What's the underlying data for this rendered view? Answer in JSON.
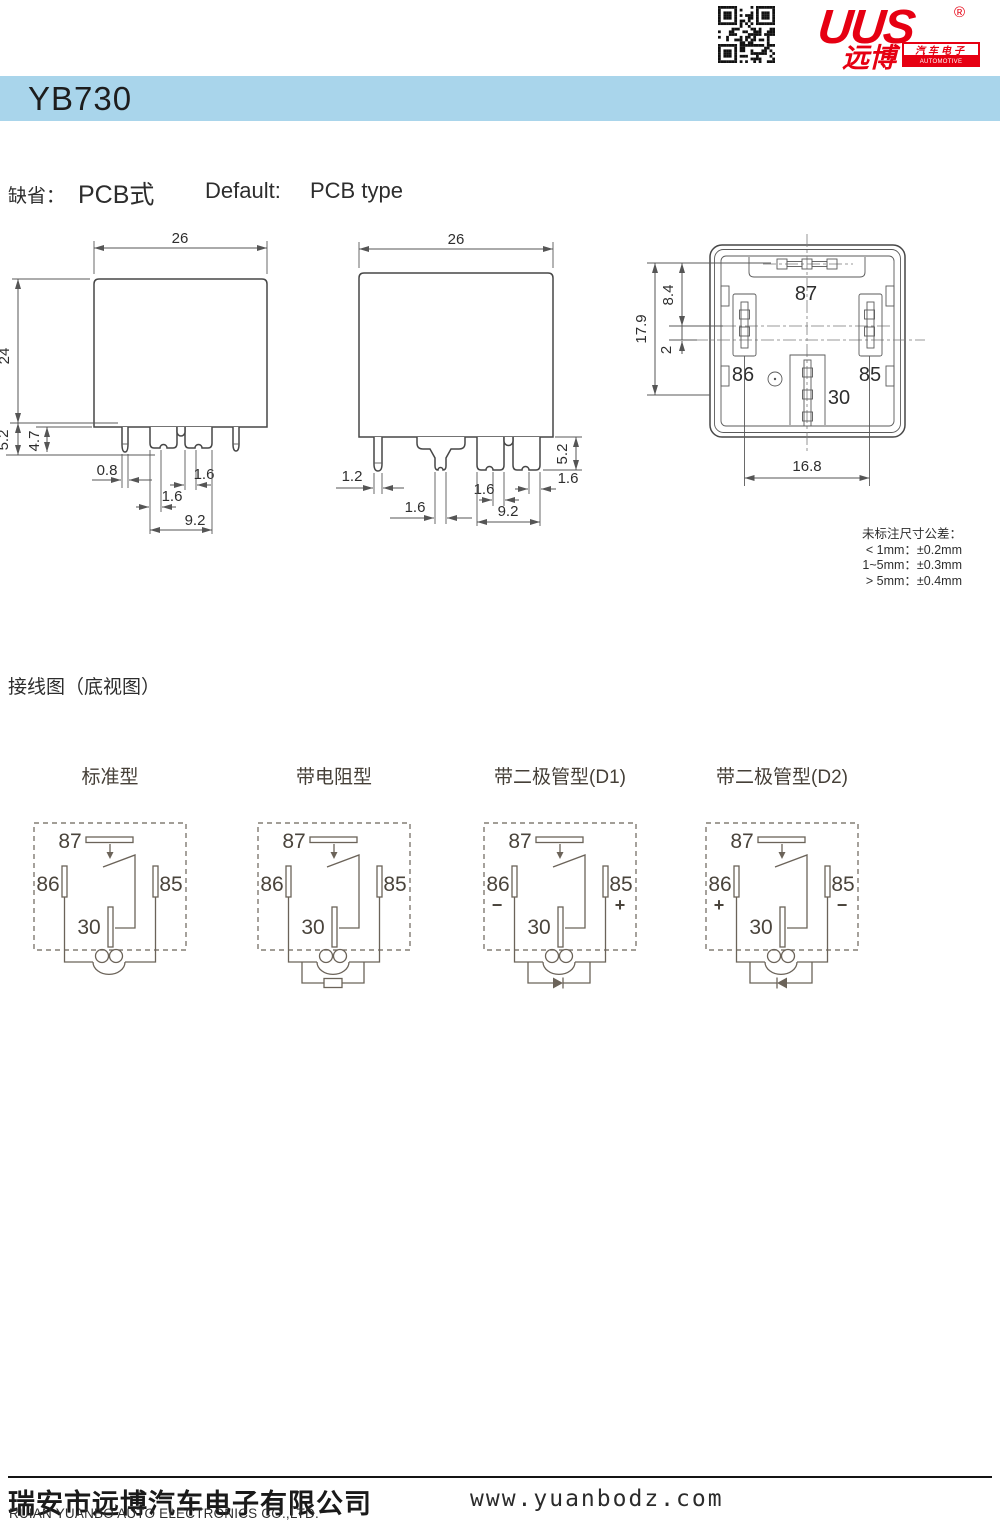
{
  "colors": {
    "accent_red": "#e60012",
    "header_blue": "#a9d5eb"
  },
  "brand": {
    "logo_text": "UUS",
    "registered": "®",
    "logo_cn": "远博",
    "logo_cn_tag": "汽车电子",
    "logo_en_tag": "AUTOMOTIVE ELECTRONICS"
  },
  "header": {
    "title": "YB730"
  },
  "default_line": {
    "label_cn": "缺省：",
    "value_cn": "PCB式",
    "label_en": "Default:",
    "value_en": "PCB type"
  },
  "drawings": {
    "side_a": {
      "w": "26",
      "h": "24",
      "pin": "5.2",
      "pin2": "4.7",
      "round": "0.8",
      "blade1": "1.6",
      "blade2": "1.6",
      "pitch": "9.2"
    },
    "side_b": {
      "w": "26",
      "round": "1.2",
      "center_blade": "1.6",
      "blade1": "1.6",
      "blade2": "1.6",
      "pitch": "9.2",
      "pin": "5.2"
    },
    "bottom": {
      "p87": "87",
      "p86": "86",
      "p85": "85",
      "p30": "30",
      "total": "17.9",
      "top_gap": "8.4",
      "mid_gap": "2",
      "span": "16.8"
    },
    "tolerance": {
      "title": "未标注尺寸公差：",
      "l1": "< 1mm：±0.2mm",
      "l2": "1~5mm：±0.3mm",
      "l3": "> 5mm：±0.4mm"
    }
  },
  "wiring": {
    "section_title": "接线图（底视图）",
    "pins": {
      "p87": "87",
      "p86": "86",
      "p85": "85",
      "p30": "30"
    },
    "diagrams": [
      {
        "title": "标准型"
      },
      {
        "title": "带电阻型"
      },
      {
        "title": "带二极管型(D1)",
        "sign86": "−",
        "sign85": "+"
      },
      {
        "title": "带二极管型(D2)",
        "sign86": "+",
        "sign85": "−"
      }
    ]
  },
  "footer": {
    "company_cn": "瑞安市远博汽车电子有限公司",
    "company_en": "RUIAN YUANBO AUTO ELECTRONICS CO.,LTD.",
    "website": "www.yuanbodz.com"
  }
}
